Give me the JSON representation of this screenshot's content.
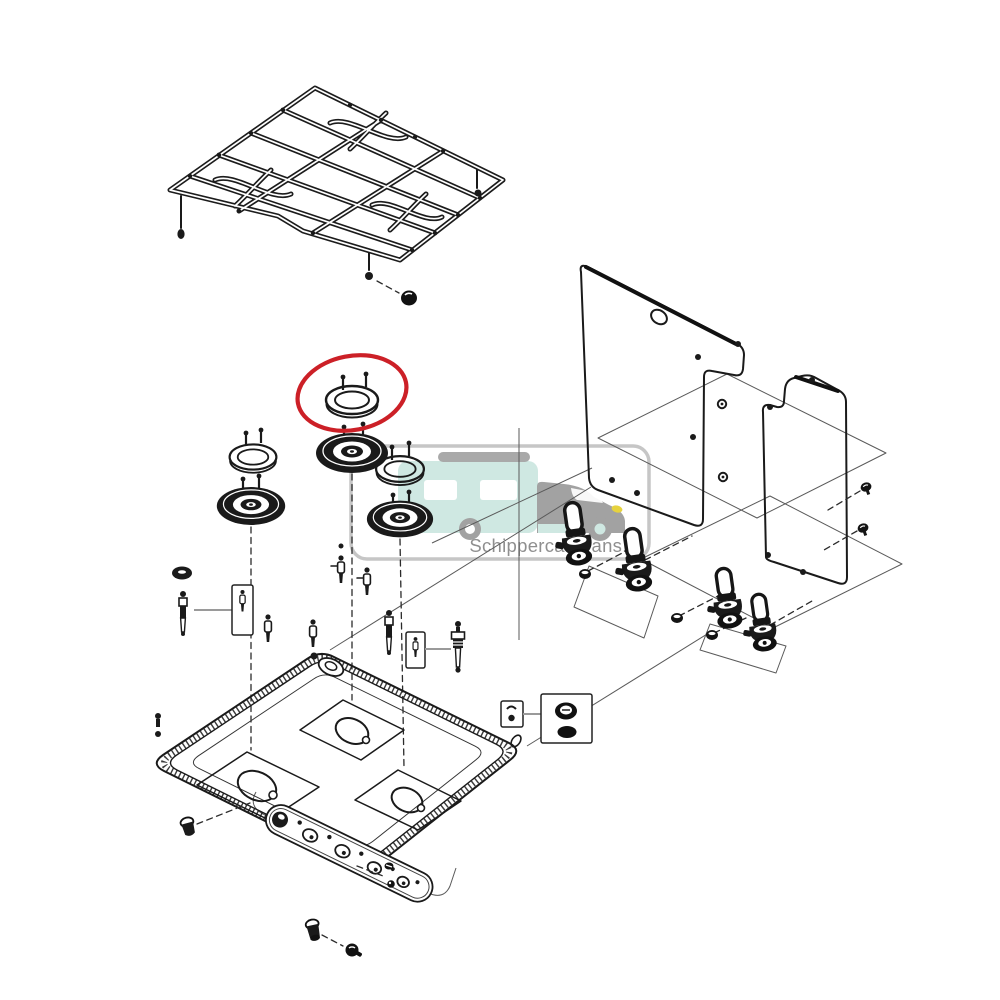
{
  "watermark": {
    "text": "Schippercaravans.nl",
    "logo": "caravan-motorhome-icon"
  },
  "colors": {
    "line": "#1a1a1a",
    "highlight_red": "#cc2027",
    "watermark_border": "#c6c6c6",
    "watermark_teal": "#cfe8e2",
    "watermark_gray": "#a2a2a2",
    "watermark_text": "#8f8f8f",
    "accent_yellow": "#e6d23e"
  },
  "highlight": {
    "shape": "ellipse",
    "marks_part": "burner_ring_highlighted",
    "color": "#cc2027"
  },
  "parts": {
    "pan_support_grid": "Pan support grid",
    "burner_ring_highlighted": "Burner ring (highlighted part)",
    "burner_ring_left": "Burner ring",
    "burner_ring_right": "Burner ring",
    "burner_cap_left": "Burner cap",
    "burner_cap_middle": "Burner cap",
    "burner_cap_right": "Burner cap",
    "ignition_electrode_left": "Ignition electrode",
    "ignition_electrode_middle": "Ignition electrode",
    "injector_callout_left": "Injector (detail box)",
    "injector_callout_middle": "Injector (detail box)",
    "thermocouple": "Thermocouple",
    "glass_lid_large": "Lid panel (large)",
    "glass_lid_small": "Lid panel (small)",
    "lid_hinges": "Lid hinge assemblies",
    "hob_tray": "Hob tray",
    "control_panel_strip": "Control panel strip",
    "cap_nut_callout": "Cap nut (detail box)",
    "fixing_hardware": "Fixing screws and nuts",
    "rubber_foot": "Rubber foot",
    "highlight_marker": "Red highlight marker"
  }
}
